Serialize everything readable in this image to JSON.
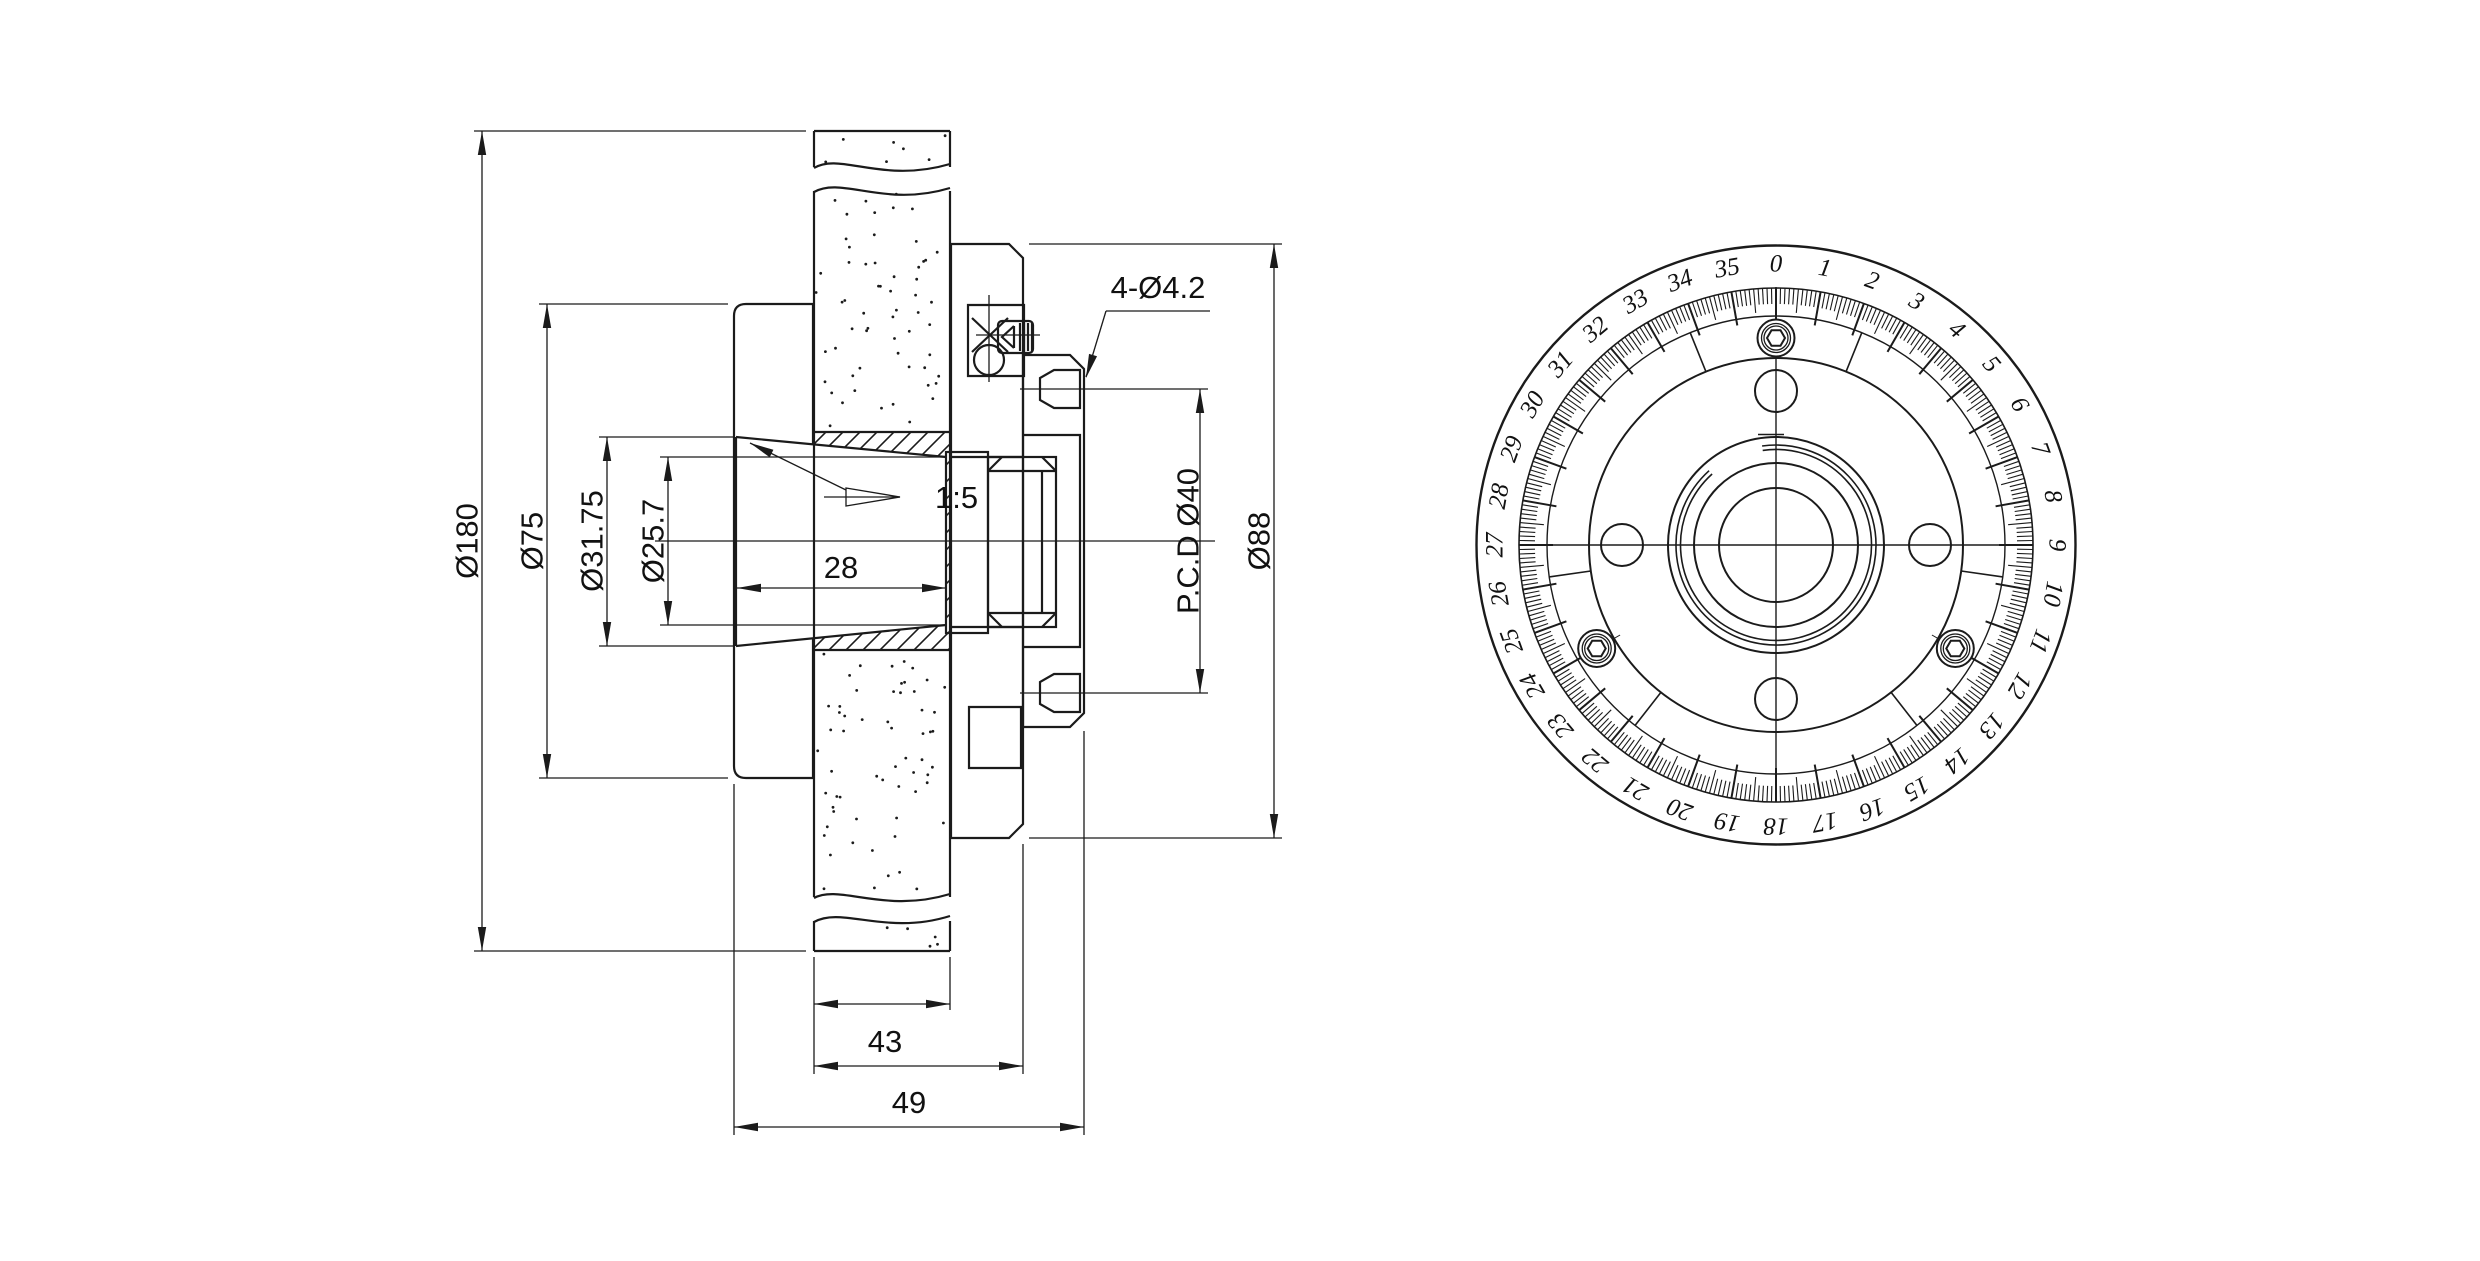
{
  "drawing": {
    "background": "#ffffff",
    "line_color": "#1b1b1b",
    "section_view": {
      "name": "sectional side view of grinding wheel hub adapter",
      "dim_labels": {
        "wheel_od": "Ø180",
        "flange_od": "Ø75",
        "taper_large": "Ø31.75",
        "taper_small": "Ø25.7",
        "taper_length": "28",
        "taper_ratio": "1:5",
        "mount_holes": "4-Ø4.2",
        "pcd": "P.C.D Ø40",
        "body_od": "Ø88",
        "hub_length": "43",
        "overall_length": "49"
      }
    },
    "dial_view": {
      "name": "graduated balancing dial end view",
      "divisions": 36,
      "minor_ticks_per_division": 10,
      "numbers": [
        "0",
        "1",
        "2",
        "3",
        "4",
        "5",
        "6",
        "7",
        "8",
        "9",
        "10",
        "11",
        "12",
        "13",
        "14",
        "15",
        "16",
        "17",
        "18",
        "19",
        "20",
        "21",
        "22",
        "23",
        "24",
        "25",
        "26",
        "27",
        "28",
        "29",
        "30",
        "31",
        "32",
        "33",
        "34",
        "35"
      ]
    }
  }
}
